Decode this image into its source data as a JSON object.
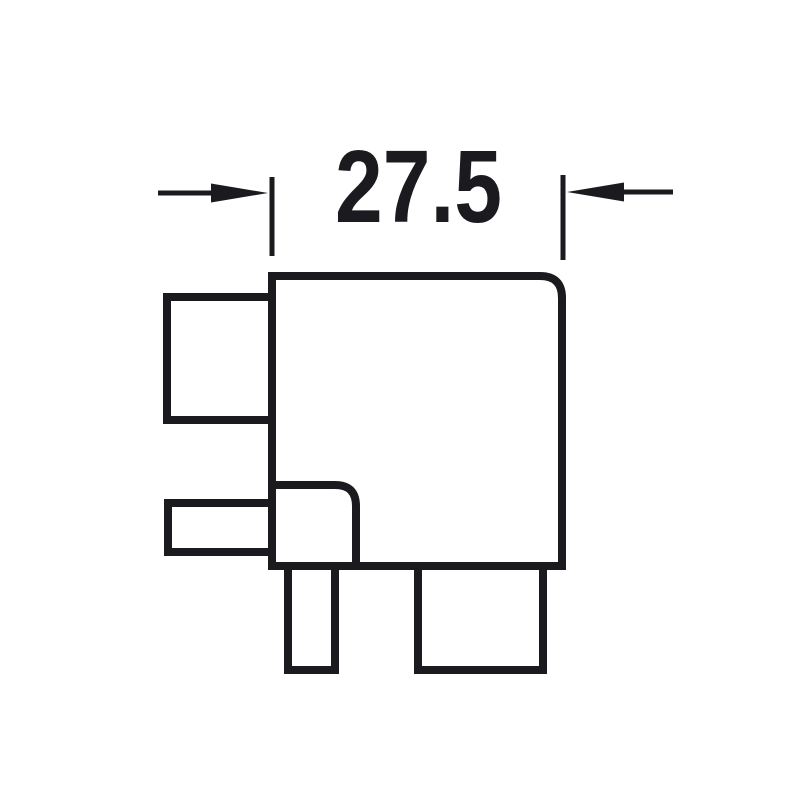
{
  "drawing": {
    "dimension_label": "27.5",
    "colors": {
      "line": "#1a1a1f",
      "background": "#ffffff"
    }
  }
}
